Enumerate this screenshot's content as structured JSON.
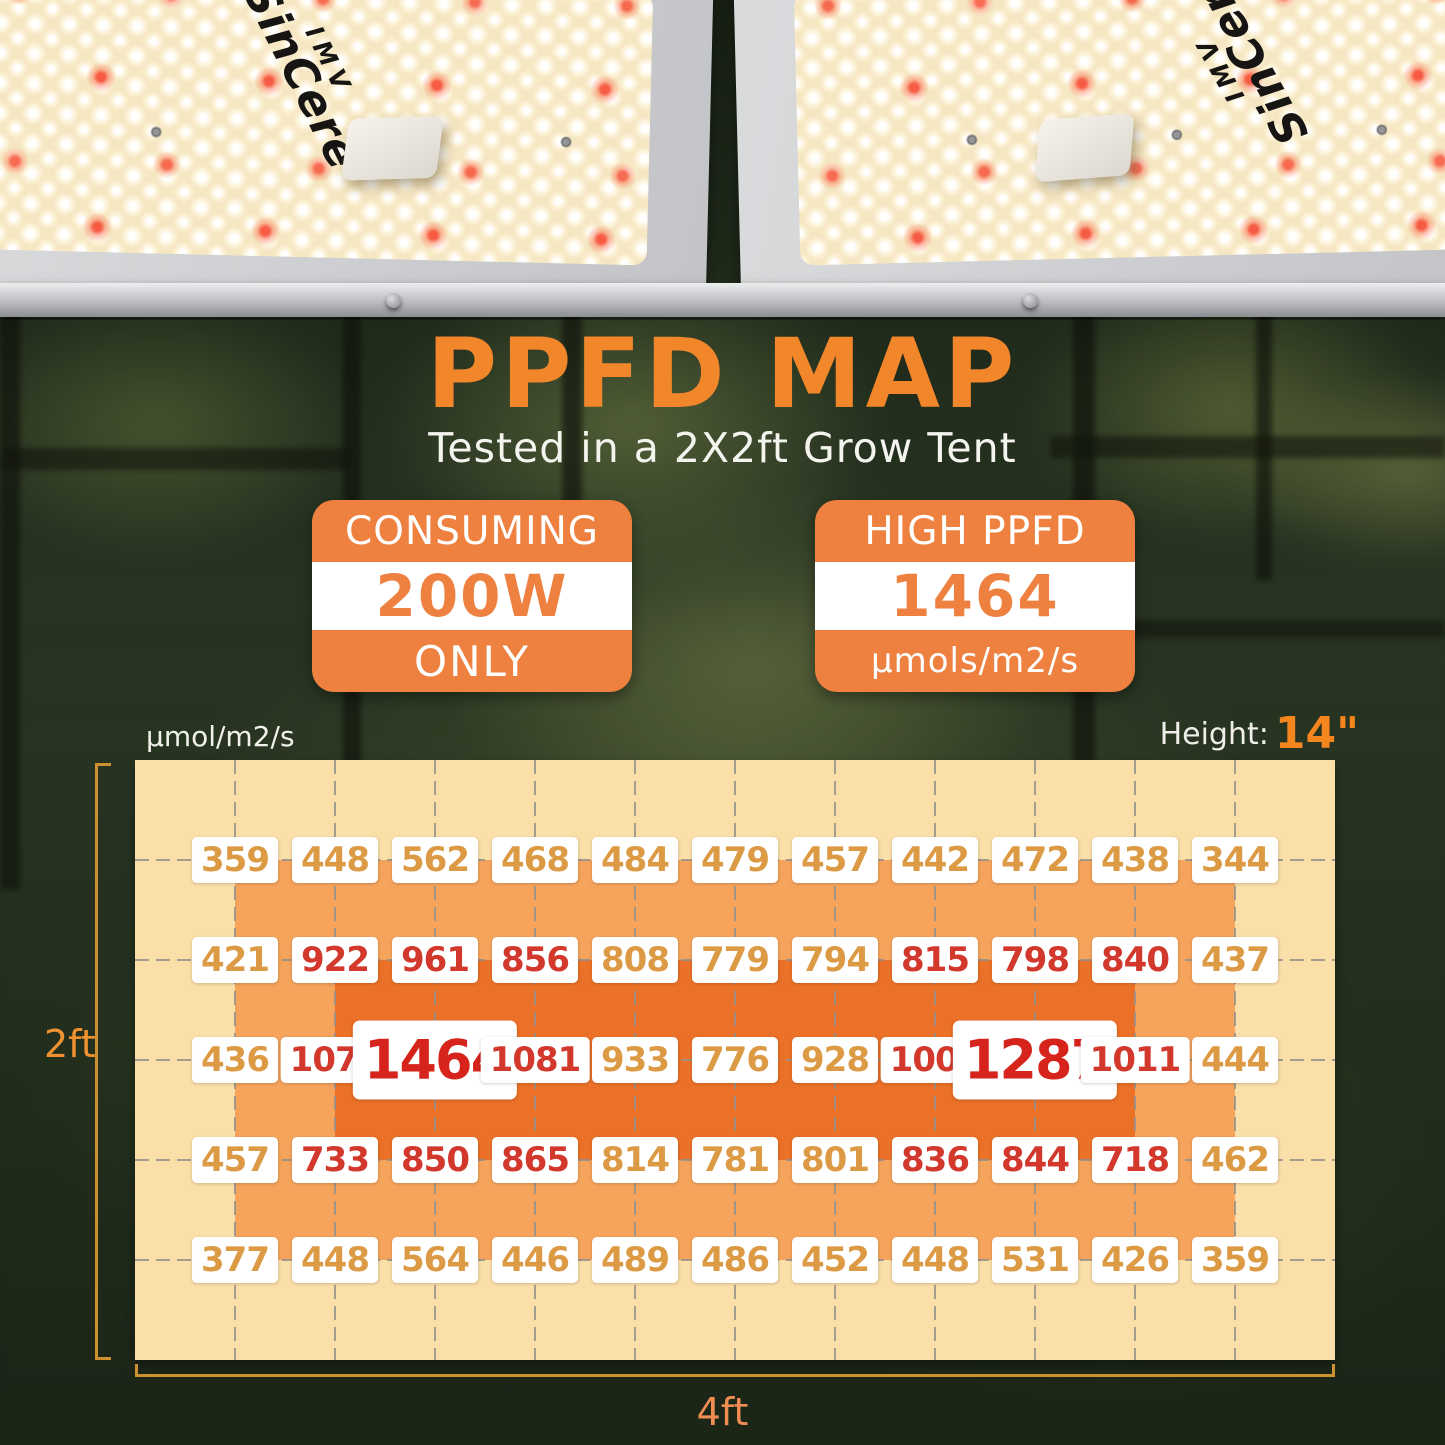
{
  "brand": {
    "line1": "IMV",
    "line2": "SinCere"
  },
  "hero": {
    "title": "PPFD MAP",
    "subtitle": "Tested in a 2X2ft Grow Tent",
    "badges": {
      "left": {
        "top": "CONSUMING",
        "value": "200W",
        "bottom": "ONLY"
      },
      "right": {
        "top": "HIGH PPFD",
        "value": "1464",
        "bottom": "μmols/m2/s"
      }
    }
  },
  "map": {
    "unit_label": "μmol/m2/s",
    "height_label": "Height:",
    "height_value": "14\"",
    "left_dim": "2ft",
    "bottom_dim": "4ft"
  },
  "chart_data": {
    "type": "heatmap",
    "title": "PPFD MAP",
    "subtitle": "Tested in a 2X2ft Grow Tent",
    "unit": "μmol/m2/s",
    "mounting_height": "14\"",
    "area": {
      "width_label": "4ft",
      "height_label": "2ft"
    },
    "grid": {
      "columns": 12,
      "rows": 6,
      "labels_at": "internal grid intersections (11 x 5)"
    },
    "peak_value": 1464,
    "power_consumption": "200W",
    "rows": [
      [
        359,
        448,
        562,
        468,
        484,
        479,
        457,
        442,
        472,
        438,
        344
      ],
      [
        421,
        922,
        961,
        856,
        808,
        779,
        794,
        815,
        798,
        840,
        437
      ],
      [
        436,
        1078,
        1464,
        1081,
        933,
        776,
        928,
        1008,
        1287,
        1011,
        444
      ],
      [
        457,
        733,
        850,
        865,
        814,
        781,
        801,
        836,
        844,
        718,
        462
      ],
      [
        377,
        448,
        564,
        446,
        489,
        486,
        452,
        448,
        531,
        426,
        359
      ]
    ],
    "cell_styles": [
      [
        "o",
        "o",
        "o",
        "o",
        "o",
        "o",
        "o",
        "o",
        "o",
        "o",
        "o"
      ],
      [
        "o",
        "r",
        "r",
        "r",
        "o",
        "o",
        "o",
        "r",
        "r",
        "r",
        "o"
      ],
      [
        "o",
        "r",
        "R",
        "r",
        "o",
        "o",
        "o",
        "r",
        "R",
        "r",
        "o"
      ],
      [
        "o",
        "r",
        "r",
        "r",
        "o",
        "o",
        "o",
        "r",
        "r",
        "r",
        "o"
      ],
      [
        "o",
        "o",
        "o",
        "o",
        "o",
        "o",
        "o",
        "o",
        "o",
        "o",
        "o"
      ]
    ],
    "style_legend": {
      "o": "orange text",
      "r": "red text",
      "R": "peak value, large red text"
    }
  },
  "colors": {
    "accent_orange": "#F2862A",
    "badge_orange": "#EE8140",
    "zone_outer": "#FBDFA9",
    "zone_mid": "#F6A45C",
    "zone_hot": "#EC7128",
    "value_orange": "#DD9A44",
    "value_red": "#D2382C",
    "value_peak_red": "#D6231B",
    "dimension_line": "#CE8F2E",
    "dimension_text": "#F0922F"
  }
}
